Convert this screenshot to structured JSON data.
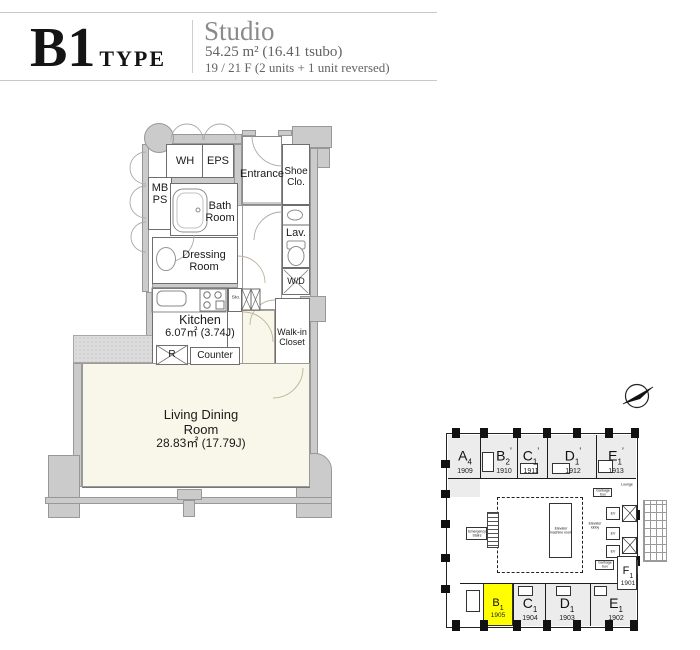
{
  "header": {
    "type_code": "B1",
    "type_word": "TYPE",
    "plan_name": "Studio",
    "area": "54.25 m² (16.41 tsubo)",
    "floors": "19 / 21 F  (2 units + 1 unit reversed)"
  },
  "floorplan": {
    "labels": {
      "wh": "WH",
      "eps": "EPS",
      "mb_ps": [
        "MB",
        "PS"
      ],
      "entrance": "Entrance",
      "shoe_closet": [
        "Shoe",
        "Clo."
      ],
      "bath_room": [
        "Bath",
        "Room"
      ],
      "lavatory": "Lav.",
      "dressing_room": [
        "Dressing",
        "Room"
      ],
      "washer_dryer": "W/D",
      "kitchen": "Kitchen",
      "kitchen_area": "6.07㎡ (3.74J)",
      "storage": "Sto.",
      "refrigerator": "R",
      "counter": "Counter",
      "walk_in_closet": [
        "Walk-in",
        "Closet"
      ],
      "living_dining": [
        "Living Dining",
        "Room"
      ],
      "living_area": "28.83㎡ (17.79J)"
    }
  },
  "sitemap": {
    "highlight_color": "#ffff00",
    "units_top": [
      {
        "letter": "A",
        "sub": "4",
        "prime": "",
        "number": "1909"
      },
      {
        "letter": "B",
        "sub": "2",
        "prime": "’",
        "number": "1910"
      },
      {
        "letter": "C",
        "sub": "1",
        "prime": "’",
        "number": "1911"
      },
      {
        "letter": "D",
        "sub": "1",
        "prime": "’",
        "number": "1912"
      },
      {
        "letter": "E",
        "sub": "1",
        "prime": "’",
        "number": "1913"
      }
    ],
    "units_bottom": [
      {
        "letter": "B",
        "sub": "1",
        "prime": "",
        "number": "1905"
      },
      {
        "letter": "C",
        "sub": "1",
        "prime": "",
        "number": "1904"
      },
      {
        "letter": "D",
        "sub": "1",
        "prime": "",
        "number": "1903"
      },
      {
        "letter": "E",
        "sub": "1",
        "prime": "",
        "number": "1902"
      }
    ],
    "unit_f": {
      "letter": "F",
      "sub": "1",
      "prime": "",
      "number": "1901"
    },
    "core": {
      "elevator_machine_room": "Elevator machine room",
      "elevator_lobby": "Elevator lobby",
      "ev": "EV",
      "lounge": "Lounge",
      "emergency_stairs": "Emergency Stairs",
      "garbage_box": "Garbage box"
    }
  }
}
